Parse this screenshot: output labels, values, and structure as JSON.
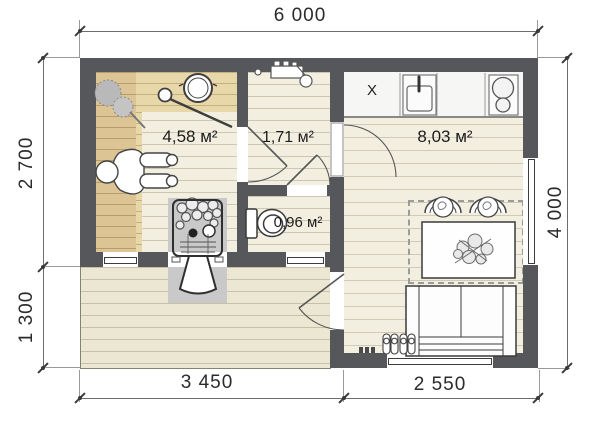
{
  "plan": {
    "dimensions": {
      "top": "6 000",
      "left_upper": "2 700",
      "left_lower": "1 300",
      "right": "4 000",
      "bottom_left": "3 450",
      "bottom_right": "2 550"
    },
    "rooms": {
      "sauna": "4,58 м²",
      "washroom": "1,71 м²",
      "wc": "0,96 м²",
      "lounge": "8,03 м²"
    },
    "labels": {
      "fridge": "X"
    },
    "colors": {
      "wall": "#56575b",
      "floor": "#f2efe0",
      "bench_wood": "#dcc495",
      "bench_wood_light": "#e8d7a9",
      "terrace": "#ece7d2",
      "stove_pad": "#c9c9c9",
      "counter": "#f6f6f4"
    }
  }
}
